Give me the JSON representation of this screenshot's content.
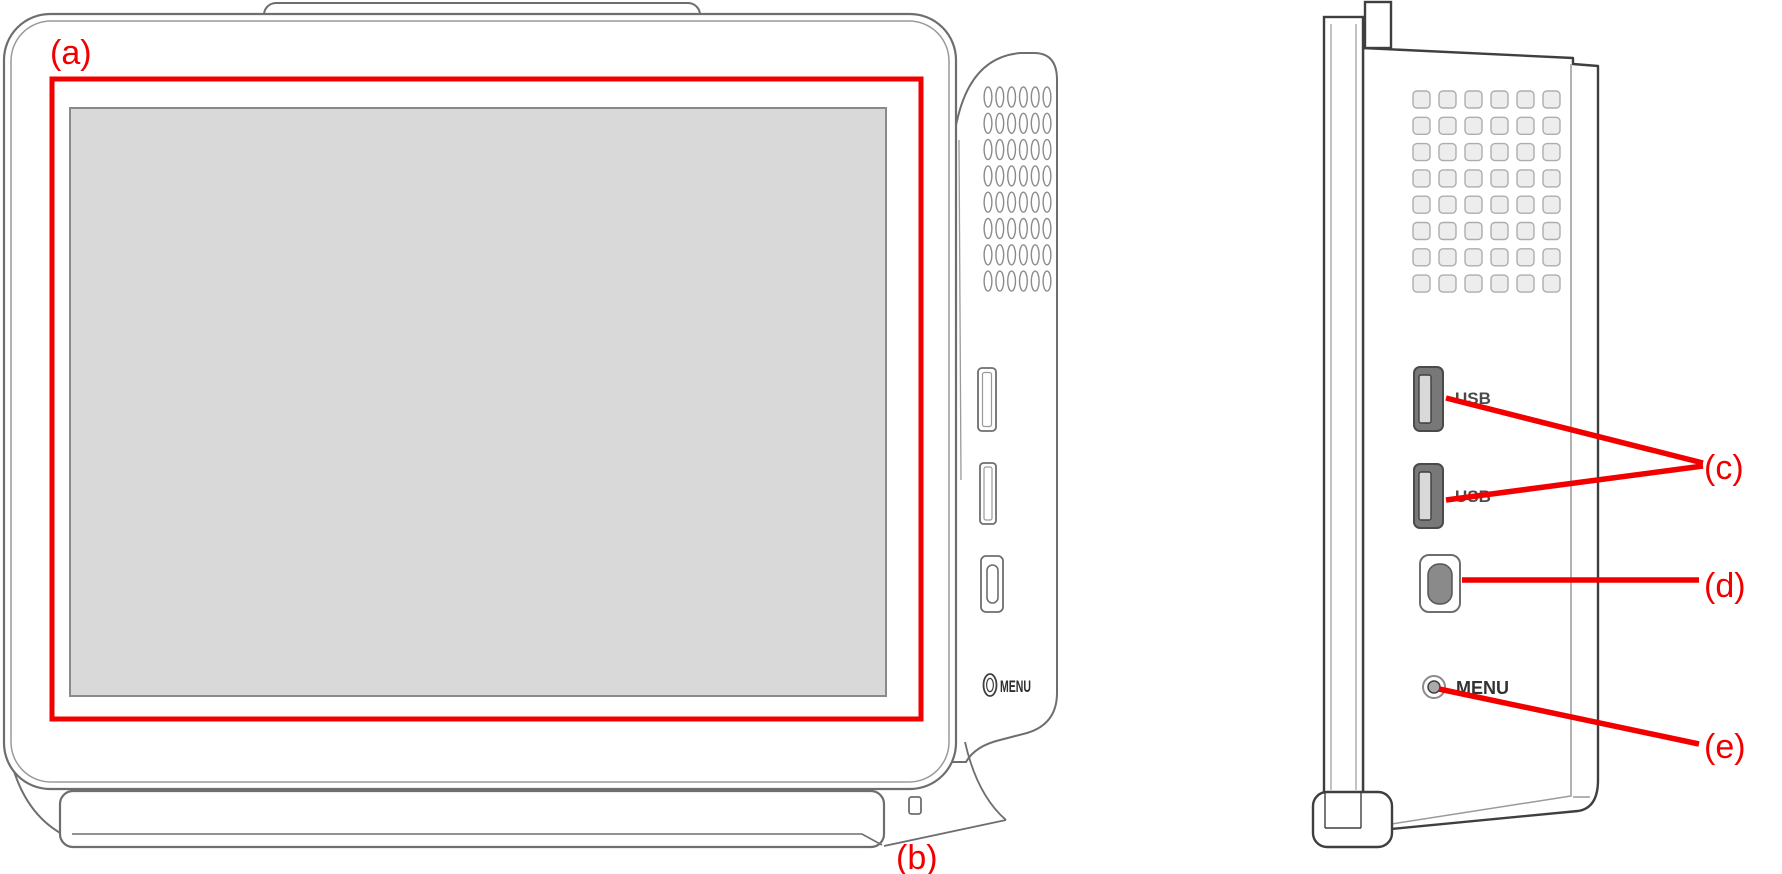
{
  "colors": {
    "annotation_red": "#f20000",
    "screen_fill": "#d9d9d9",
    "screen_border": "#8a8a8a",
    "outline_dark": "#3f3f3f",
    "outline_mid": "#6e6e6e",
    "outline_light": "#9a9a9a",
    "vent_fill": "#ededed",
    "vent_border": "#adadad",
    "port_fill": "#787878",
    "port_slot_fill": "#d9d9d9",
    "port_label_text": "#4a4a4a"
  },
  "annotations": {
    "a": "(a)",
    "b": "(b)",
    "c": "(c)",
    "d": "(d)",
    "e": "(e)"
  },
  "front_view": {
    "menu_button_label": "MENU"
  },
  "side_view": {
    "usb_port_top_label": "USB",
    "usb_port_bottom_label": "USB",
    "menu_button_label": "MENU"
  }
}
